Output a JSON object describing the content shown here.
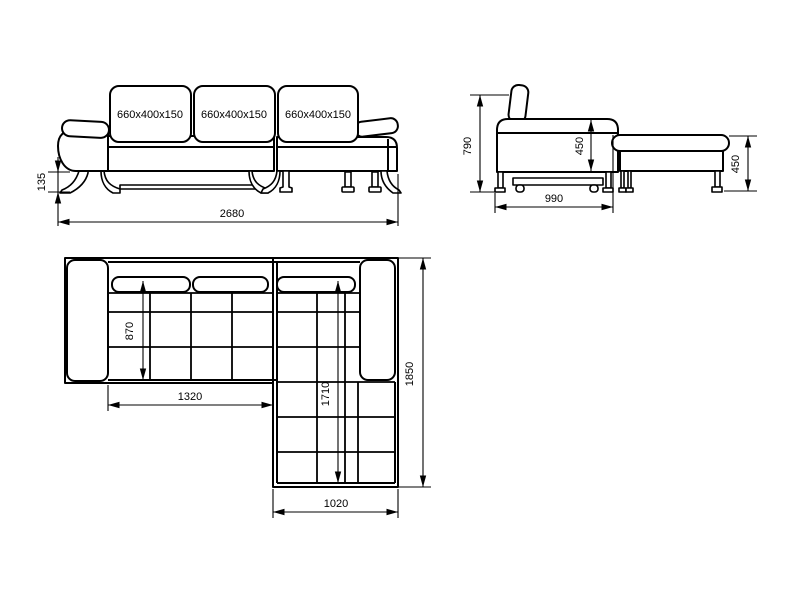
{
  "colors": {
    "background": "#ffffff",
    "line": "#000000"
  },
  "front_view": {
    "cushion_labels": [
      "660x400x150",
      "660x400x150",
      "660x400x150"
    ],
    "dimensions": {
      "leg_height": "135",
      "total_width": "2680"
    }
  },
  "side_view": {
    "dimensions": {
      "back_height": "790",
      "seat_height": "450",
      "depth": "990",
      "chaise_height": "450"
    }
  },
  "plan_view": {
    "dimensions": {
      "seat_depth": "870",
      "sofa_section_width": "1320",
      "chaise_length": "1710",
      "total_length": "1850",
      "chaise_width": "1020"
    }
  }
}
